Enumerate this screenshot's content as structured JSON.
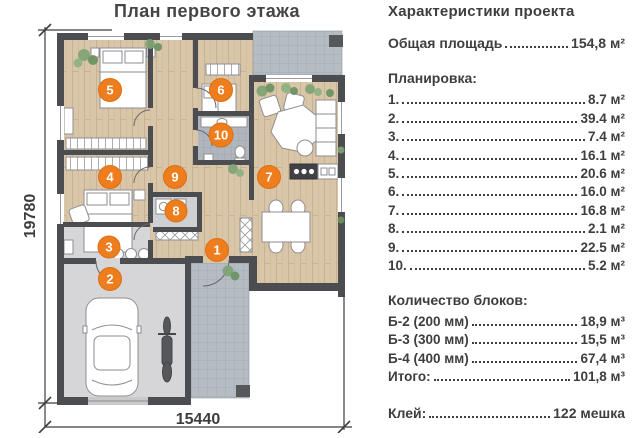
{
  "title": "План первого этажа",
  "dims": {
    "height": "19780",
    "width": "15440"
  },
  "markers": [
    {
      "label": "1"
    },
    {
      "label": "2"
    },
    {
      "label": "3"
    },
    {
      "label": "4"
    },
    {
      "label": "5"
    },
    {
      "label": "6"
    },
    {
      "label": "7"
    },
    {
      "label": "8"
    },
    {
      "label": "9"
    },
    {
      "label": "10"
    }
  ],
  "panel": {
    "heading": "Характеристики проекта",
    "total": {
      "label": "Общая площадь",
      "value": "154,8 м²"
    },
    "layout_heading": "Планировка:",
    "rooms": [
      {
        "num": "1.",
        "area": "8.7 м²"
      },
      {
        "num": "2.",
        "area": "39.4 м²"
      },
      {
        "num": "3.",
        "area": "7.4 м²"
      },
      {
        "num": "4.",
        "area": "16.1 м²"
      },
      {
        "num": "5.",
        "area": "20.6 м²"
      },
      {
        "num": "6.",
        "area": "16.0 м²"
      },
      {
        "num": "7.",
        "area": "16.8 м²"
      },
      {
        "num": "8.",
        "area": "2.1 м²"
      },
      {
        "num": "9.",
        "area": "22.5 м²"
      },
      {
        "num": "10.",
        "area": "5.2 м²"
      }
    ],
    "blocks_heading": "Количество блоков:",
    "blocks": [
      {
        "label": "Б-2 (200 мм)",
        "value": "18,9 м³"
      },
      {
        "label": "Б-3 (300 мм)",
        "value": "15,5 м³"
      },
      {
        "label": "Б-4 (400 мм)",
        "value": "67,4 м³"
      },
      {
        "label": "Итого:",
        "value": "101,8 м³"
      }
    ],
    "glue": {
      "label": "Клей:",
      "value": "122 мешка"
    }
  },
  "colors": {
    "accent_orange": "#ee7d1e",
    "text_gray": "#3e3e41",
    "wall_gray": "#4b4d51",
    "wood_floor": "#d9c6a8",
    "concrete_floor": "#d6d6d8",
    "tile_floor": "#b5bcc3"
  }
}
